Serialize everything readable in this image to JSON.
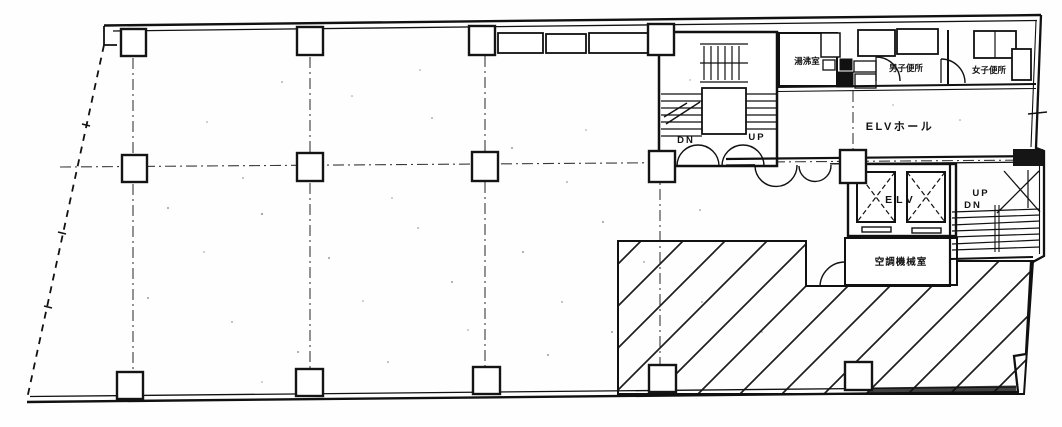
{
  "floor_plan": {
    "rooms": {
      "elv_hall_label": "ELVホール",
      "elevator_label": "ELV",
      "kitchenette_label": "湯沸室",
      "mens_toilet_label": "男子便所",
      "womens_toilet_label": "女子便所",
      "machine_room_label": "空調機械室"
    },
    "stairs": {
      "left": {
        "dn": "DN",
        "up": "UP"
      },
      "right": {
        "up": "UP",
        "dn": "DN"
      }
    }
  }
}
